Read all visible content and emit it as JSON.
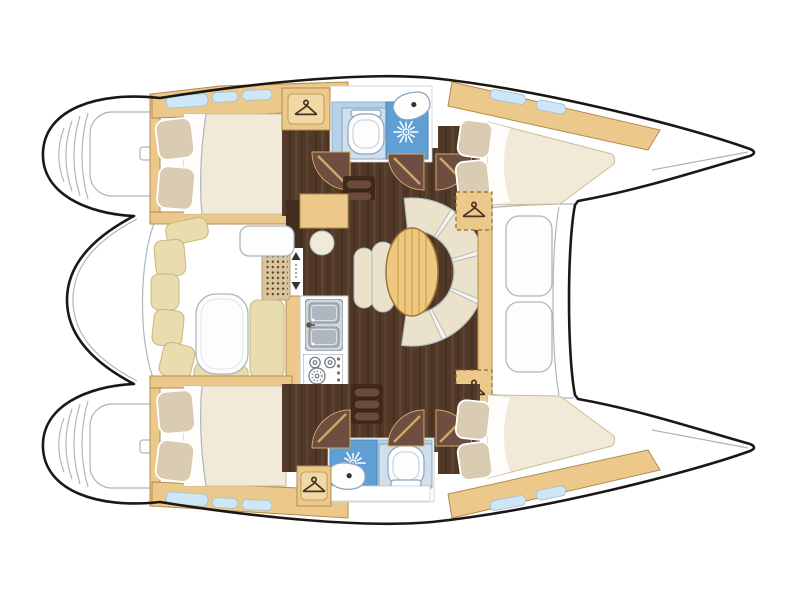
{
  "design": {
    "colors": {
      "hull_line": "#1c1713",
      "line_gray": "#aeb6bd",
      "wood": "#ecc88b",
      "wood_inner": "#f0d9a4",
      "wood_border": "#b08c4f",
      "wood_dash": "#8a6a3a",
      "wenge": "#523827",
      "wenge_dark": "#432d1f",
      "door_disc": "#6e4e40",
      "door_leaf": "#d2a868",
      "bed": "#f1ead8",
      "bed_border": "#c9bc98",
      "pillow": "#d9ccb3",
      "sofa": "#ebe2cc",
      "sofa_base": "#f7f4eb",
      "sofa_line": "#b2bac2",
      "table_wood": "#eec87e",
      "table_grain": "#d2a257",
      "table_border": "#9a7336",
      "cushion": "#e9dcae",
      "cushion_border": "#c9b67f",
      "white": "#fdfdfd",
      "bath_blue": "#b5d1e8",
      "bath_border": "#8fb2cd",
      "shower_blue": "#5f9fd3",
      "shower_border": "#4a85b8",
      "toilet_panel": "#cfdfee",
      "fixture_line": "#8aa4bc",
      "window_blue": "#cfe6f5",
      "window_border": "#9fc0d8",
      "steel": "#cfd5da",
      "basin": "#aeb7bf",
      "steel_dark": "#78828c",
      "mat": "#d8c59c",
      "mat_border": "#b6a276",
      "mat_dot": "#50381f",
      "step_base": "#41291c",
      "step_bar": "#6b4a38",
      "step_edge": "#2e1c12",
      "hanger_color": "#4a3222",
      "appliance_line": "#6a7680"
    }
  },
  "plan": {
    "vessel": "catamaran-floor-plan",
    "areas": [
      {
        "id": "cockpit"
      },
      {
        "id": "saloon-dinette"
      },
      {
        "id": "navigation-table"
      },
      {
        "id": "galley"
      },
      {
        "id": "port-aft-cabin"
      },
      {
        "id": "port-head"
      },
      {
        "id": "port-forward-cabin"
      },
      {
        "id": "starboard-aft-cabin"
      },
      {
        "id": "starboard-head"
      },
      {
        "id": "starboard-forward-cabin"
      },
      {
        "id": "foredeck"
      },
      {
        "id": "port-transom"
      },
      {
        "id": "starboard-transom"
      }
    ],
    "icons": [
      "hanger-icon",
      "shower-head-icon",
      "toilet-icon",
      "washbasin-icon",
      "double-sink-icon",
      "stove-icon",
      "companionway-steps-icon",
      "door-swing-icon",
      "sliding-door-arrows-icon",
      "window-icon"
    ]
  }
}
